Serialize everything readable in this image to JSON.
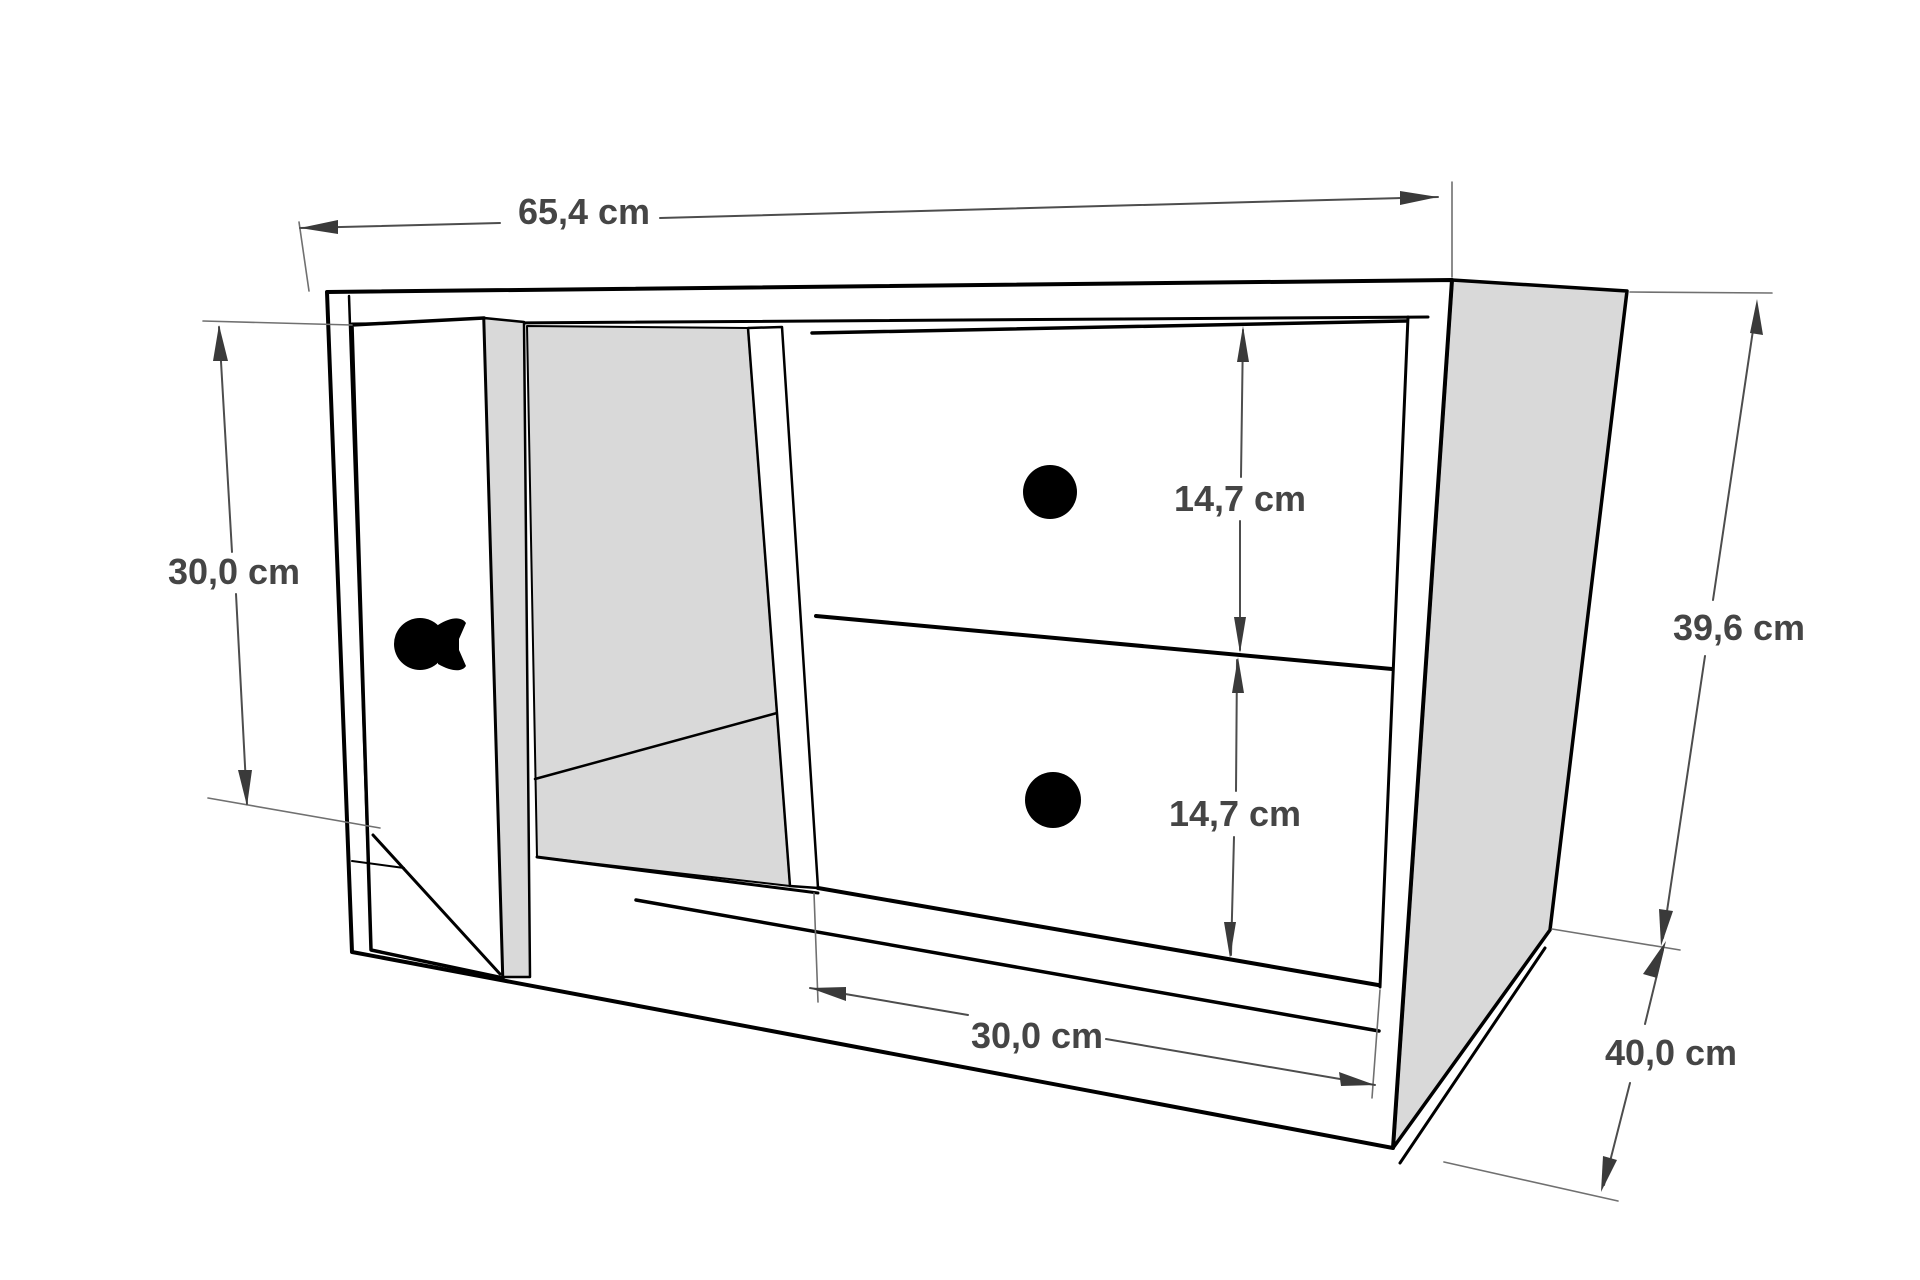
{
  "diagram": {
    "dimensions": {
      "width_top": "65,4 cm",
      "door_height": "30,0 cm",
      "upper_drawer_height": "14,7 cm",
      "lower_drawer_height": "14,7 cm",
      "total_height": "39,6 cm",
      "drawer_width": "30,0 cm",
      "depth": "40,0 cm"
    },
    "colors": {
      "background": "#ffffff",
      "outline": "#000000",
      "panel_fill": "#d9d9d9",
      "dimension_line": "#4d4d4d",
      "dimension_text": "#454545",
      "knob_fill": "#000000"
    }
  }
}
